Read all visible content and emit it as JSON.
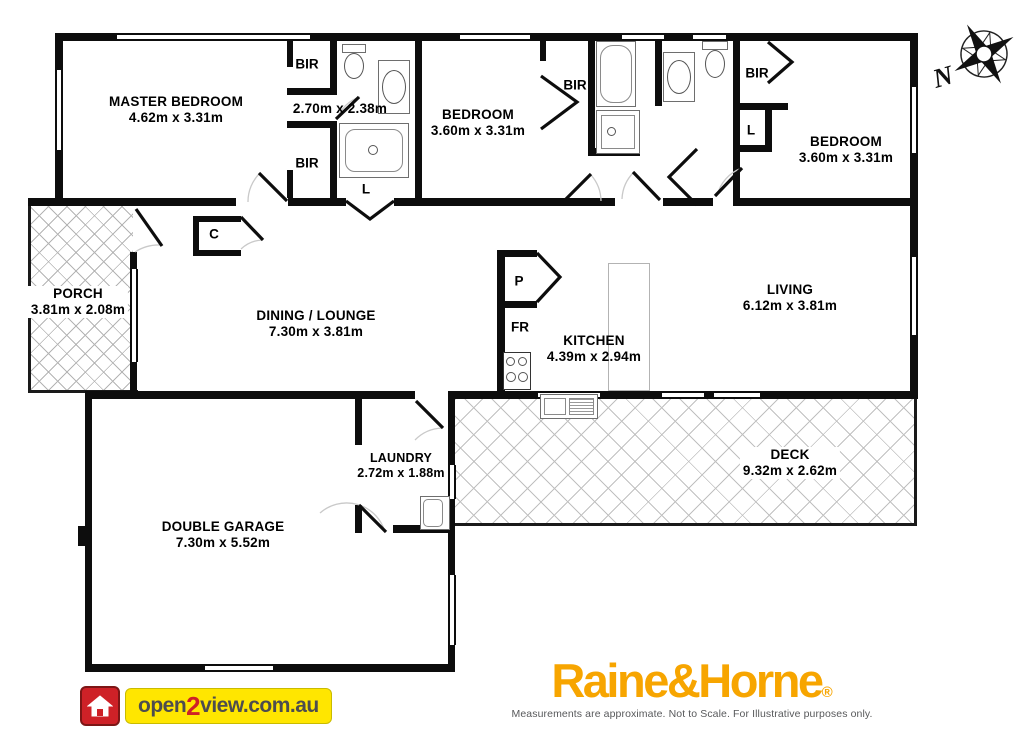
{
  "rooms": {
    "master": {
      "name": "MASTER BEDROOM",
      "dims": "4.62m x 3.31m"
    },
    "ensuite": {
      "dims": "2.70m x 2.38m"
    },
    "bedroom2": {
      "name": "BEDROOM",
      "dims": "3.60m x 3.31m"
    },
    "bedroom3": {
      "name": "BEDROOM",
      "dims": "3.60m x 3.31m"
    },
    "porch": {
      "name": "PORCH",
      "dims": "3.81m x 2.08m"
    },
    "dining": {
      "name": "DINING / LOUNGE",
      "dims": "7.30m x 3.81m"
    },
    "kitchen": {
      "name": "KITCHEN",
      "dims": "4.39m x 2.94m"
    },
    "living": {
      "name": "LIVING",
      "dims": "6.12m x 3.81m"
    },
    "laundry": {
      "name": "LAUNDRY",
      "dims": "2.72m x 1.88m"
    },
    "garage": {
      "name": "DOUBLE GARAGE",
      "dims": "7.30m x 5.52m"
    },
    "deck": {
      "name": "DECK",
      "dims": "9.32m x 2.62m"
    }
  },
  "labels": {
    "built_in_robe": "BIR",
    "linen": "L",
    "cupboard": "C",
    "pantry": "P",
    "fridge": "FR"
  },
  "compass": {
    "north": "N"
  },
  "branding": {
    "open2view": {
      "text_open": "open",
      "text_2": "2",
      "text_rest": "view.com.au",
      "bg": "#FFE600",
      "accent_red": "#CE2127",
      "text_color": "#4D4D4F"
    },
    "raine_horne": {
      "name": "Raine&Horne",
      "registered": "®",
      "color": "#F7A500",
      "disclaimer": "Measurements are approximate. Not to Scale. For Illustrative purposes only."
    }
  }
}
